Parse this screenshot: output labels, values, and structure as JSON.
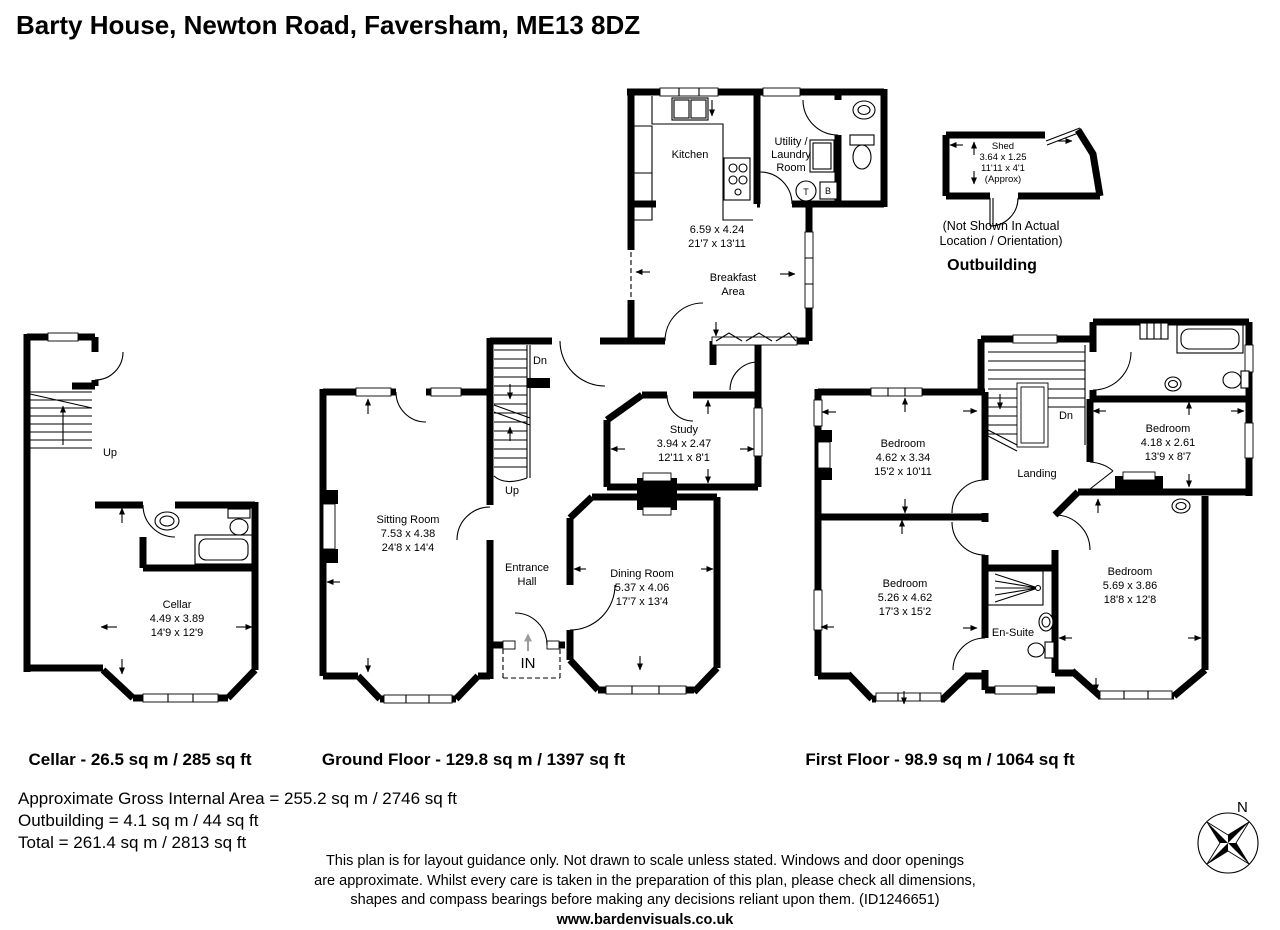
{
  "title": "Barty House, Newton Road, Faversham, ME13 8DZ",
  "colors": {
    "wall": "#000000",
    "in_arrow_gray": "#9c9c9c"
  },
  "cellar": {
    "area_label": "Cellar - 26.5 sq m / 285 sq ft",
    "room": {
      "name": "Cellar",
      "metric": "4.49 x 3.89",
      "imperial": "14'9 x 12'9"
    },
    "up": "Up"
  },
  "ground": {
    "area_label": "Ground Floor - 129.8 sq m / 1397 sq ft",
    "kitchen": {
      "name": "Kitchen",
      "metric": "6.59 x 4.24",
      "imperial": "21'7 x 13'11"
    },
    "breakfast_line1": "Breakfast",
    "breakfast_line2": "Area",
    "utility_line1": "Utility /",
    "utility_line2": "Laundry",
    "utility_line3": "Room",
    "sitting": {
      "name": "Sitting Room",
      "metric": "7.53 x 4.38",
      "imperial": "24'8 x 14'4"
    },
    "study": {
      "name": "Study",
      "metric": "3.94 x 2.47",
      "imperial": "12'11 x 8'1"
    },
    "dining": {
      "name": "Dining Room",
      "metric": "5.37 x 4.06",
      "imperial": "17'7 x 13'4"
    },
    "entrance_line1": "Entrance",
    "entrance_line2": "Hall",
    "in_label": "IN",
    "up": "Up",
    "dn": "Dn",
    "tank_label": "T",
    "boiler_label": "B"
  },
  "first": {
    "area_label": "First Floor - 98.9 sq m / 1064 sq ft",
    "bedroom1": {
      "name": "Bedroom",
      "metric": "4.62 x 3.34",
      "imperial": "15'2 x 10'11"
    },
    "bedroom2": {
      "name": "Bedroom",
      "metric": "5.26 x 4.62",
      "imperial": "17'3 x 15'2"
    },
    "bedroom3": {
      "name": "Bedroom",
      "metric": "4.18 x 2.61",
      "imperial": "13'9 x 8'7"
    },
    "bedroom4": {
      "name": "Bedroom",
      "metric": "5.69 x 3.86",
      "imperial": "18'8 x 12'8"
    },
    "ensuite": "En-Suite",
    "landing": "Landing",
    "dn": "Dn"
  },
  "outbuilding": {
    "heading": "Outbuilding",
    "note_line1": "(Not Shown In Actual",
    "note_line2": "Location / Orientation)",
    "shed": {
      "name": "Shed",
      "metric": "3.64 x 1.25",
      "imperial": "11'11 x 4'1",
      "approx": "(Approx)"
    }
  },
  "summary": {
    "line1": "Approximate Gross Internal Area = 255.2 sq m / 2746 sq ft",
    "line2": "Outbuilding = 4.1 sq m / 44 sq ft",
    "line3": "Total = 261.4 sq m / 2813 sq ft"
  },
  "disclaimer": {
    "line1": "This plan is for layout guidance only. Not drawn to scale unless stated. Windows and door openings",
    "line2": "are approximate. Whilst every care is taken in the preparation of this plan, please check all dimensions,",
    "line3": "shapes and compass bearings before making any decisions reliant upon them. (ID1246651)",
    "line4": "www.bardenvisuals.co.uk"
  },
  "compass": {
    "north": "N"
  }
}
